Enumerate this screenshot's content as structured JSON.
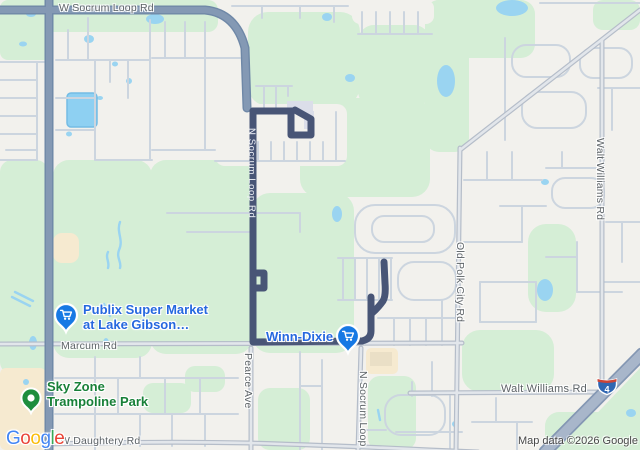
{
  "map_labels": {
    "w_socrum_loop_rd": "W Socrum Loop Rd",
    "n_socrum_loop_rd_route": "N Socrum Loop Rd",
    "marcum_rd": "Marcum Rd",
    "pearce_ave": "Pearce Ave",
    "n_socrum_loop_south": "N Socrum Loop",
    "w_daughtery_rd": "W Daughtery Rd",
    "old_polk_city_rd": "Old Polk City Rd",
    "walt_williams_rd_vertical": "Walt Williams Rd",
    "walt_williams_rd_horizontal": "Walt Williams Rd"
  },
  "places": {
    "publix": {
      "line1": "Publix Super Market",
      "line2": "at Lake Gibson…",
      "pin_color": "#1779e4",
      "label_color": "#2668df"
    },
    "winn_dixie": {
      "name": "Winn-Dixie",
      "pin_color": "#1779e4",
      "label_color": "#2668df"
    },
    "sky_zone": {
      "line1": "Sky Zone",
      "line2": "Trampoline Park",
      "pin_color": "#1e8e3e",
      "label_color": "#188038"
    }
  },
  "route": {
    "color": "#485576",
    "on_road": "N Socrum Loop Rd"
  },
  "highway_shield": {
    "number": "4"
  },
  "attribution": "Map data ©2026 Google",
  "logo": {
    "letters": [
      {
        "c": "G"
      },
      {
        "c": "o"
      },
      {
        "c": "o"
      },
      {
        "c": "g"
      },
      {
        "c": "l"
      },
      {
        "c": "e"
      }
    ],
    "colors": [
      "#4285F4",
      "#EA4335",
      "#FBBC05",
      "#4285F4",
      "#34A853",
      "#EA4335"
    ]
  },
  "colors": {
    "water": "#9ad4f1",
    "park_green": "#d5eed6",
    "commercial_beige": "#f6ead0",
    "background": "#f2f1ed",
    "major_road": "#8499b4",
    "highway": "#a8b6ca"
  }
}
